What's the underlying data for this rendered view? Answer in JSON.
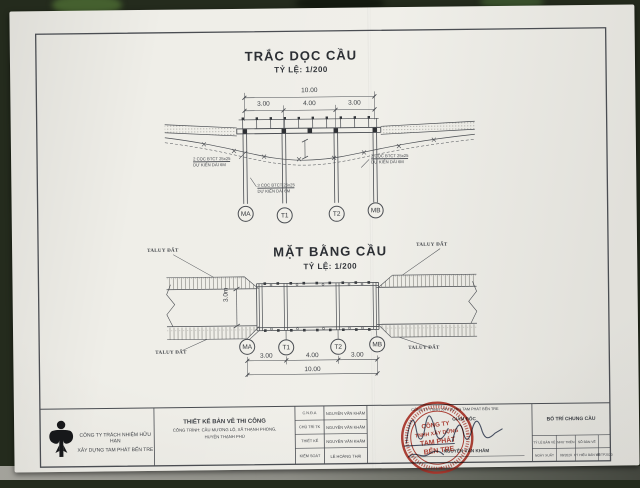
{
  "section": {
    "title": "TRẮC DỌC CẦU",
    "scale": "TỶ LỆ:  1/200",
    "dim_total": "10.00",
    "dim_segments": [
      "3.00",
      "4.00",
      "3.00"
    ],
    "pile_notes": [
      {
        "line1": "2 CỌC BTCT 25x25",
        "line2": "DỰ KIẾN DÀI 6M"
      },
      {
        "line1": "3 CỌC BTCT 25x25",
        "line2": "DỰ KIẾN DÀI 6M"
      },
      {
        "line1": "2 CỌC BTCT 25x25",
        "line2": "DỰ KIẾN DÀI 6M"
      }
    ]
  },
  "plan": {
    "title": "MẶT BẰNG CẦU",
    "scale": "TỶ LỆ:  1/200",
    "width_dim": "3.0m",
    "taluy": "TALUY ĐẤT",
    "dim_total": "10.00",
    "dim_segments": [
      "3.00",
      "4.00",
      "3.00"
    ]
  },
  "supports": [
    "MA",
    "T1",
    "T2",
    "MB"
  ],
  "title_block": {
    "company": {
      "line1": "CÔNG TY TRÁCH NHIỆM HỮU HẠN",
      "line2": "XÂY DỰNG TAM PHÁT BẾN TRE"
    },
    "design_stage": "THIẾT KẾ BẢN VẼ THI CÔNG",
    "project": {
      "line1": "CÔNG TRÌNH: CẦU MƯƠNG LỘ, XÃ THẠNH PHONG,",
      "line2": "HUYỆN THẠNH PHÚ"
    },
    "roles": [
      {
        "label": "C.N.Đ.A",
        "name": "NGUYỄN VĂN KHẮM"
      },
      {
        "label": "CHỦ TRÌ TK",
        "name": "NGUYỄN VĂN KHẮM"
      },
      {
        "label": "THIẾT KẾ",
        "name": "NGUYỄN VĂN KHẮM"
      },
      {
        "label": "KIỂM SOÁT",
        "name": "LÊ HOÀNG THÁI"
      }
    ],
    "approval": {
      "company": "CÔNG TY TNHH XÂY DỰNG TAM PHÁT BẾN TRE",
      "role": "GIÁM ĐỐC",
      "name": "NGUYỄN VĂN KHẮM"
    },
    "stamp": {
      "line1": "CÔNG TY",
      "line2": "TNHH XÂY DỰNG",
      "line3": "TAM PHÁT",
      "line4": "BẾN TRE",
      "star": "★"
    },
    "drawing_info": {
      "name": "BỐ TRÍ CHUNG CẦU",
      "scale_label": "TỶ LỆ BẢN VẼ",
      "scale_value": "NHƯ TRÊN",
      "number_label": "SỐ BẢN VẼ",
      "number_value": "",
      "date_label": "NGÀY XUẤT",
      "date_value": "08/2020",
      "code_label": "KÝ HIỆU BẢN VẼ",
      "code_value": "08/TP2020"
    }
  },
  "colors": {
    "stamp_red": "#b5362b",
    "ink": "#4a4d52",
    "signature_ink": "#2e3a55"
  }
}
